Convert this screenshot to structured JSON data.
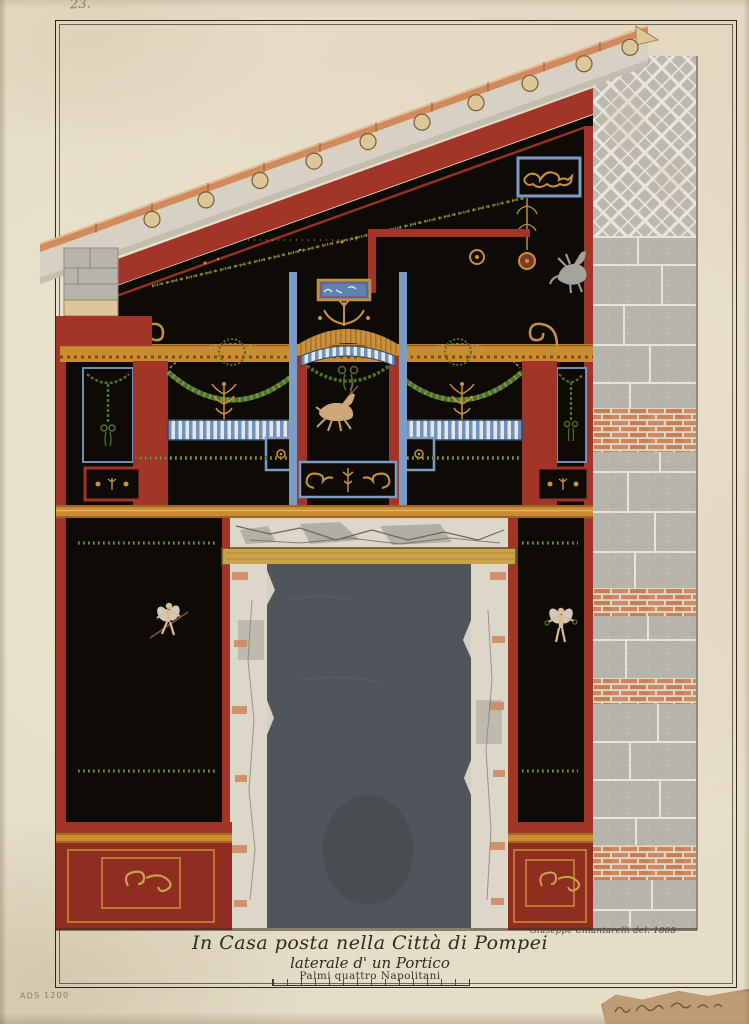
{
  "artwork": {
    "corner_number": "23.",
    "archive_mark": "ADS 1200",
    "title_caption": {
      "line1": "In Casa posta nella Città di Pompei",
      "line2": "laterale d' un Portico",
      "line3": "Palmi quattro Napolitani"
    },
    "signature": "Giuseppe Chiantarelli del. 1808"
  },
  "colors": {
    "paper": "#e6ddc6",
    "ink": "#30291f",
    "faded_ink": "#8a7c66",
    "black_field": "#0e0b07",
    "pompeian_red": "#a23527",
    "dado_red": "#8e2d20",
    "ochre_band": "#c98c32",
    "gold": "#c9913c",
    "garland_green": "#50702e",
    "frame_blue": "#7d9cc5",
    "pinax_blue": "#5c82b8",
    "door_slate": "#50555b",
    "stone_grey": "#b7b4ac",
    "mortar": "#e7e4da",
    "plaster": "#dcd7c8",
    "brick": "#cf8a64",
    "tile": "#d08a5e",
    "soffit": "#d6d1c3",
    "rafter_tan": "#dcc79b",
    "flesh": "#dcbb95",
    "silver": "#a4a49c",
    "lintel_wood": "#c9a24a",
    "scrap_tan": "#c09c74"
  }
}
